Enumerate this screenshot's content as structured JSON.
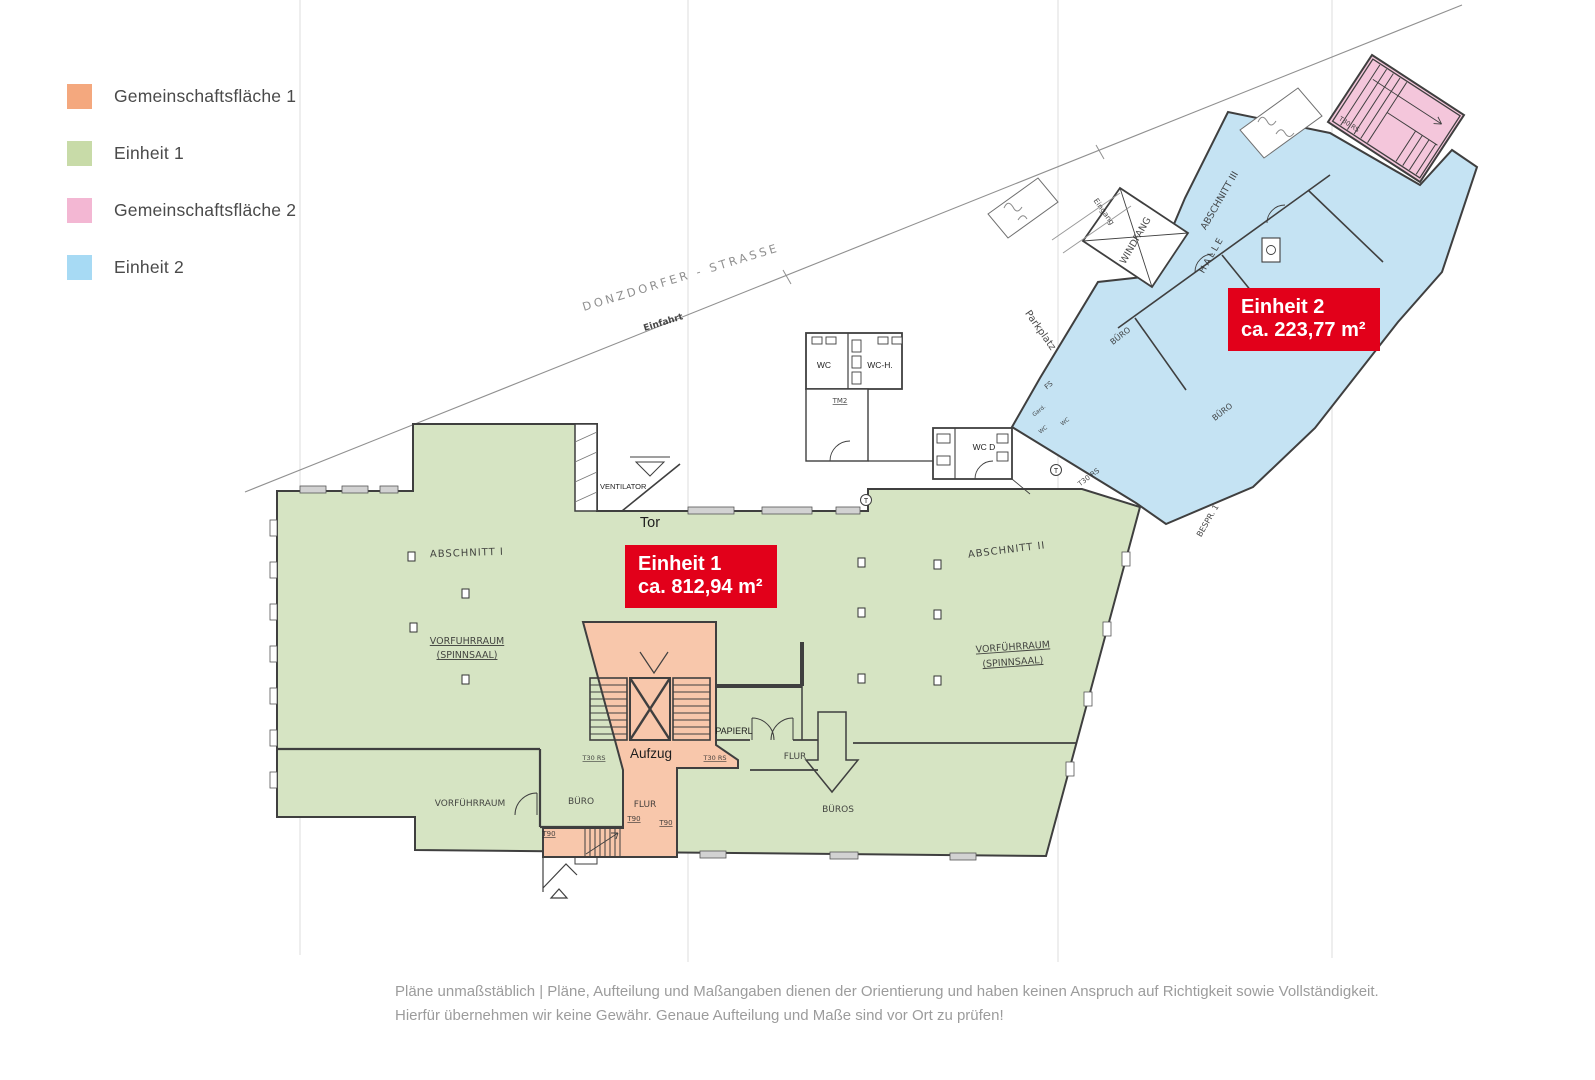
{
  "legend": {
    "items": [
      {
        "label": "Gemeinschaftsfläche 1",
        "color": "#f4a87e"
      },
      {
        "label": "Einheit 1",
        "color": "#c8dba8"
      },
      {
        "label": "Gemeinschaftsfläche 2",
        "color": "#f3b7d3"
      },
      {
        "label": "Einheit 2",
        "color": "#a7daf4"
      }
    ]
  },
  "unit_badges": [
    {
      "name": "Einheit 1",
      "area": "ca. 812,94 m²"
    },
    {
      "name": "Einheit 2",
      "area": "ca. 223,77 m²"
    }
  ],
  "plan": {
    "labels": {
      "street": "DONZDORFER - STRASSE",
      "einfahrt": "Einfahrt",
      "parkplatz": "Parkplatz",
      "eingang": "Eingang",
      "windfang": "WINDFANG",
      "halle": "HALLE",
      "abschnitt_1": "ABSCHNITT I",
      "abschnitt_2": "ABSCHNITT II",
      "abschnitt_3": "ABSCHNITT III",
      "vorfuehrraum": "VORFÜHRRAUM",
      "spinnsaal": "(SPINNSAAL)",
      "buero": "BÜRO",
      "bueros": "BÜROS",
      "flur": "FLUR",
      "papierl": "PAPIERL",
      "aufzug": "Aufzug",
      "tor": "Tor",
      "ventilator": "VENTILATOR",
      "wc": "WC",
      "wc_h": "WC-H.",
      "wc_d": "WC D",
      "gard": "Gard.",
      "fs": "FS",
      "bespr_1": "BESPR. 1",
      "t30_rs": "T30 RS",
      "t90": "T90",
      "tm2": "TM2",
      "t": "T"
    },
    "region_colors": {
      "einheit1": "#d6e4c3",
      "gemeinschaft1": "#f8c7ab",
      "einheit2": "#c5e3f3",
      "gemeinschaft2": "#f4c6db",
      "wall": "#3f3f3f"
    }
  },
  "accent_red": "#e2001a",
  "disclaimer": {
    "line1": "Pläne unmaßstäblich | Pläne, Aufteilung und Maßangaben dienen der Orientierung und haben keinen Anspruch auf Richtigkeit sowie Vollständigkeit.",
    "line2": "Hierfür übernehmen wir keine Gewähr. Genaue Aufteilung und Maße sind vor Ort zu prüfen!"
  }
}
